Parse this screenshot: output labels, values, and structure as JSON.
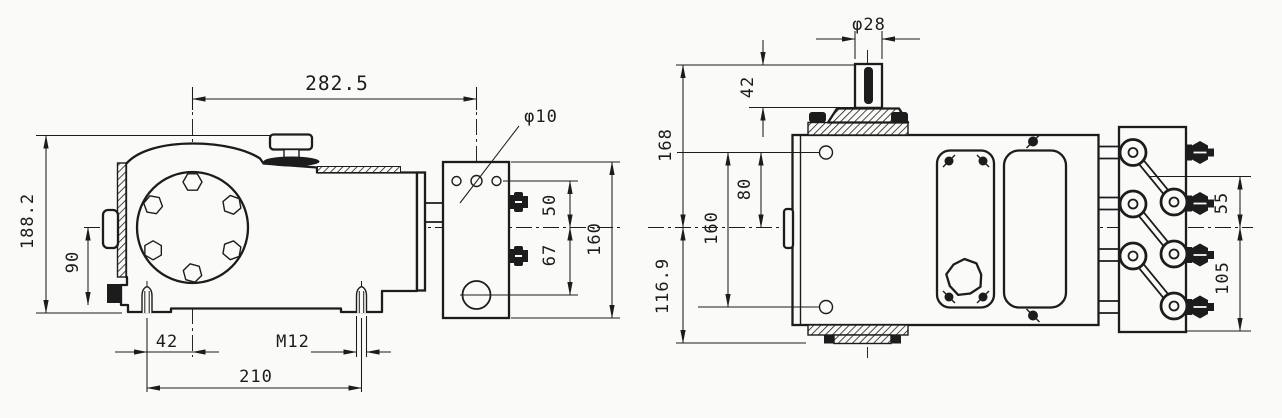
{
  "drawing": {
    "type": "pump-outline-dimension-drawing",
    "ink_color": "#1c1c1c",
    "paper_color": "#fafaf8",
    "side_view": {
      "dims": {
        "crank_to_manifold_center": "282.5",
        "manifold_hole_diameter": "φ10",
        "overall_height": "188.2",
        "base_to_centerline": "90",
        "centerline_to_upper_port": "50",
        "centerline_to_lower_port": "67",
        "manifold_height": "160",
        "stud_to_crank_center": "42",
        "stud_thread": "M12",
        "stud_spacing": "210"
      }
    },
    "top_view": {
      "dims": {
        "shaft_diameter": "φ28",
        "shaft_extension": "42",
        "shaft_end_to_centerline": "168",
        "bolt_hole_to_centerline": "80",
        "bolt_hole_spacing": "160",
        "centerline_to_rear": "116.9",
        "valve_to_centerline": "55",
        "valve_spacing": "105"
      }
    }
  }
}
